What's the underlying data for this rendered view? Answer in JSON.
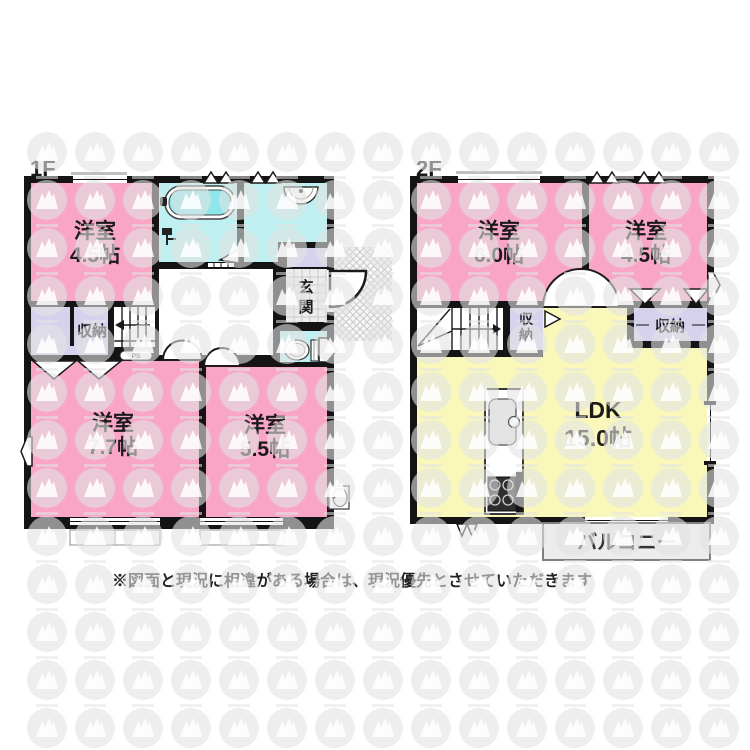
{
  "disclaimer": "※図面と現況に相違がある場合は、現況優先とさせていただきます",
  "floors": [
    {
      "label": "1F",
      "rooms": [
        {
          "name": "洋室",
          "size": "4.5帖"
        },
        {
          "name": "洋室",
          "size": "7.7帖"
        },
        {
          "name": "洋室",
          "size": "5.5帖"
        }
      ],
      "storage_label": "収納",
      "entrance_chars": [
        "玄",
        "関"
      ],
      "ps_label": "PS"
    },
    {
      "label": "2F",
      "rooms": [
        {
          "name": "洋室",
          "size": "6.0帖"
        },
        {
          "name": "洋室",
          "size": "4.5帖"
        },
        {
          "name": "LDK",
          "size": "15.0帖"
        }
      ],
      "storage_chars": [
        "収",
        "納"
      ],
      "storage_label": "収納",
      "balcony_label": "バルコニー"
    }
  ],
  "colors": {
    "wall": "#141414",
    "pink": "#F8A5C6",
    "cyan": "#BFEFF1",
    "tub_water": "#8FE6EA",
    "lavender": "#D6D2EE",
    "yellow": "#FAF7BB",
    "genkan_tile": "#EDEDED",
    "hatch": "#C8C8C8",
    "balcony_fill": "#ECECEC",
    "balcony_border": "#808080",
    "watermark": "#E3E3E3"
  }
}
